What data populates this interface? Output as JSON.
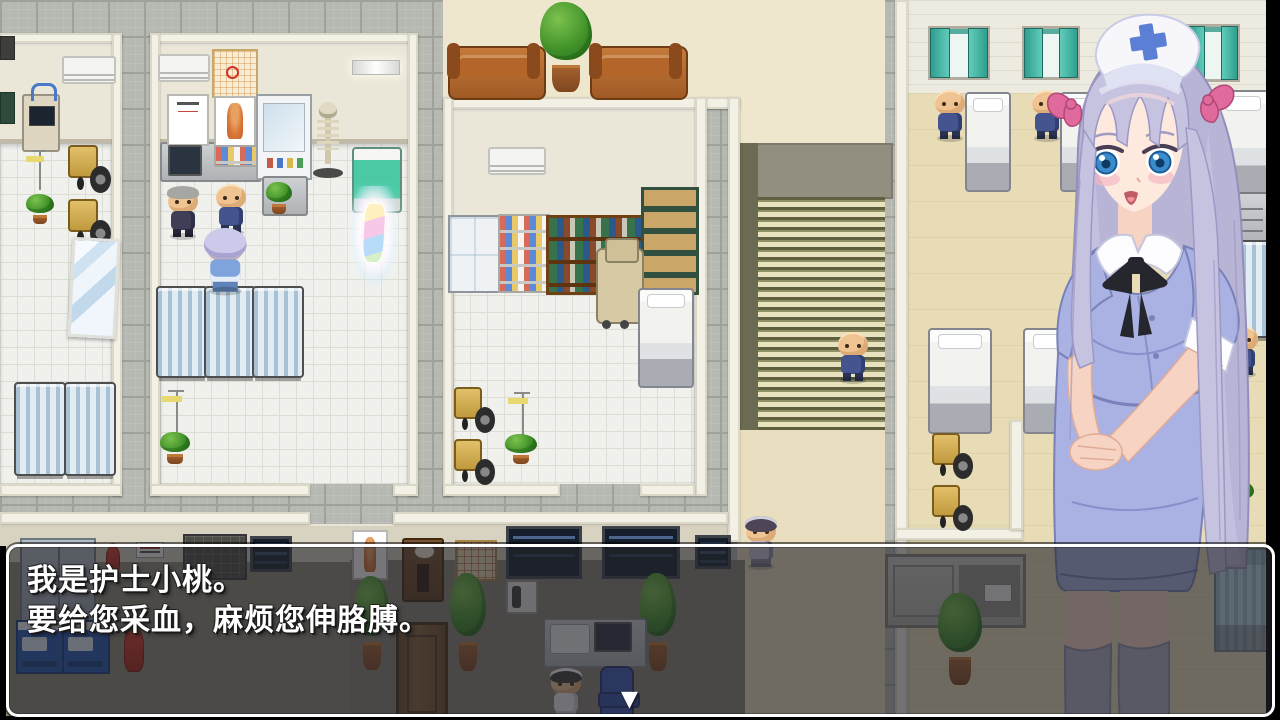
{
  "dialogue": {
    "line1": "我是护士小桃。",
    "line2": "要给您采血，麻烦您伸胳膊。",
    "continue_indicator": "▼"
  },
  "portrait": {
    "character": "护士小桃"
  },
  "colors": {
    "dialog_border": "#ffffff",
    "dialog_overlay": "rgba(35,35,42,0.62)",
    "nurse_dress": "#a9b2e3",
    "nurse_hair": "#c2bfdf",
    "cap_cross": "#5b7fd4",
    "hair_ribbon": "#e06a9c",
    "stairs_stripe": "#5f6040",
    "ward_floor": "#e7dcb6",
    "corridor_tile": "#b6b8b2"
  }
}
